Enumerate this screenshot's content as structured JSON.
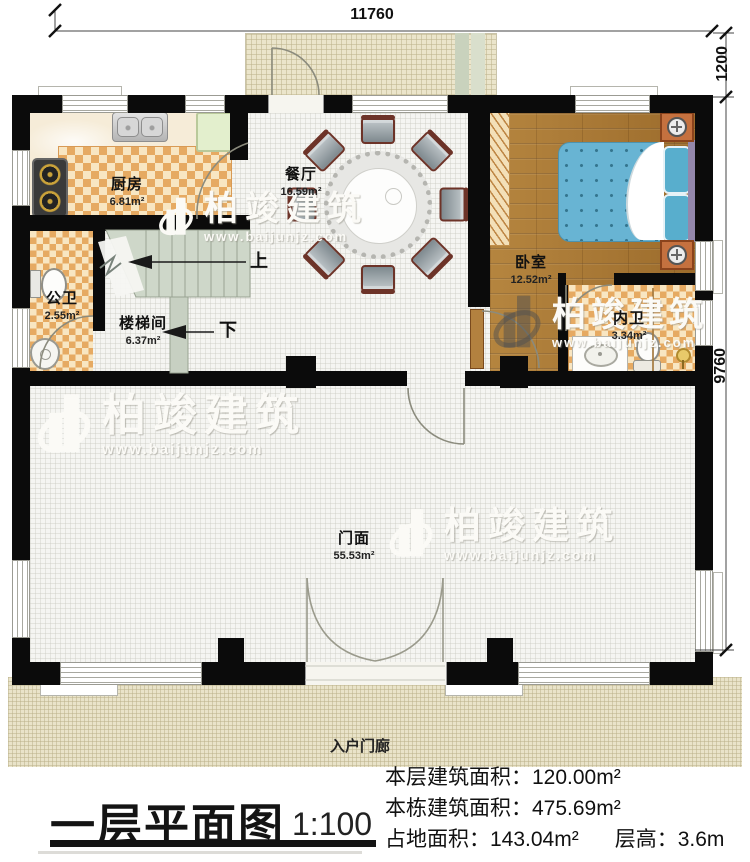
{
  "plan": {
    "rooms": [
      {
        "name": "厨房",
        "area": "6.81m²"
      },
      {
        "name": "餐厅",
        "area": "16.59m²"
      },
      {
        "name": "卧室",
        "area": "12.52m²"
      },
      {
        "name": "公卫",
        "area": "2.55m²"
      },
      {
        "name": "楼梯间",
        "area": "6.37m²"
      },
      {
        "name": "内卫",
        "area": "3.34m²"
      },
      {
        "name": "门面",
        "area": "55.53m²"
      }
    ],
    "porch_label": "入户门廊",
    "stair": {
      "up": "上",
      "down": "下"
    }
  },
  "dimensions": {
    "top_width": "11760",
    "right_upper": "1200",
    "right_lower": "9760"
  },
  "watermark": {
    "brand": "柏竣建筑",
    "url": "www.baijunjz.com"
  },
  "title_block": {
    "title": "一层平面图",
    "scale": "1:100",
    "stats": [
      {
        "label": "本层建筑面积：",
        "value": "120.00m²"
      },
      {
        "label": "本栋建筑面积：",
        "value": "475.69m²"
      },
      {
        "label": "占地面积：",
        "value": "143.04m²"
      },
      {
        "label": "层高：",
        "value": "3.6m"
      }
    ]
  },
  "colors": {
    "wall": "#0b0b0b",
    "floorGrid": "#f5f5f2",
    "checkA": "#e6aa62",
    "checkB": "#f8e6c2",
    "wood": "#ab7a38",
    "bedBlue": "#68b4d3",
    "stairGreen": "#ced7c9",
    "terrace": "#ebe5cb",
    "porch": "#e9e3c9",
    "furnOrange": "#c5713f"
  }
}
